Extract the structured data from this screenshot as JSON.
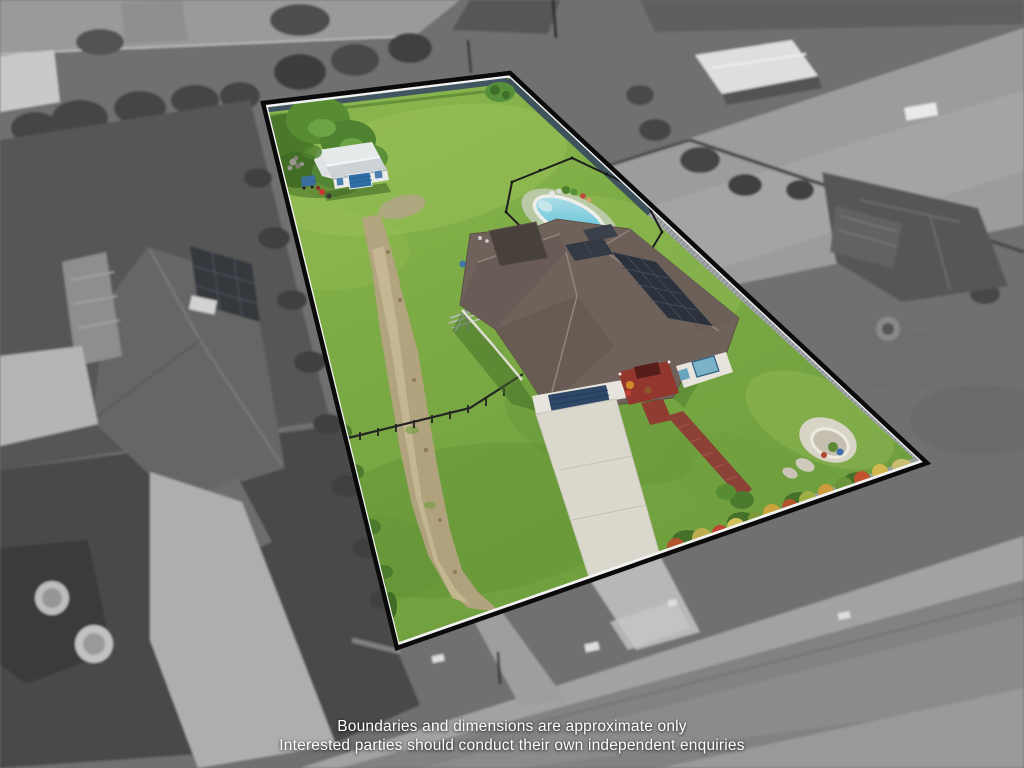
{
  "image": {
    "kind": "aerial-drone-real-estate-photo",
    "description": "Oblique aerial photo of a residential acreage lot highlighted in colour with a black boundary outline; surrounding neighbourhood is desaturated greyscale"
  },
  "disclaimer": {
    "line1": "Boundaries and dimensions are approximate only",
    "line2": "Interested parties should conduct their own independent enquiries"
  },
  "palette": {
    "surroundings_gray": "#6f6f6f",
    "grass": "#7fae49",
    "boundary_outline": "#0a0a0a",
    "boundary_inner_line": "#f2f2f2",
    "pool_water": "#7ccbdd",
    "house_roof": "#6f625b",
    "solar_panels": "#2b323c",
    "garage_door": "#2e4769",
    "shed_roof": "#e6e9ea",
    "shed_door": "#2f6da6",
    "driveway_concrete": "#dad7cd",
    "timber_walkway": "#8c4136",
    "gravel_track": "#b5a383",
    "colorbond_fence": "#415660"
  },
  "scene": {
    "lot": {
      "boundary_shape": "quadrilateral",
      "corners_px": [
        [
          263,
          103
        ],
        [
          510,
          73
        ],
        [
          927,
          463
        ],
        [
          397,
          648
        ]
      ],
      "features": [
        "lawn",
        "main-house",
        "hip-tile-roof",
        "solar-panels",
        "garage-door",
        "entry-porch",
        "swimming-pool",
        "pool-fence",
        "garden-shed",
        "gravel-track",
        "concrete-driveway",
        "timber-walkway",
        "flower-garden-bed",
        "stone-circle-feature",
        "corner-trees",
        "colorbond-fence",
        "yard-fence",
        "clothesline"
      ]
    },
    "surroundings": {
      "desaturated": true,
      "features": [
        "street-bottom",
        "road-top-left",
        "neighbor-house-left",
        "neighbor-house-right",
        "neighbor-carport-shed",
        "gravel-yard-right",
        "driveways",
        "trees",
        "garden-circles"
      ]
    }
  }
}
